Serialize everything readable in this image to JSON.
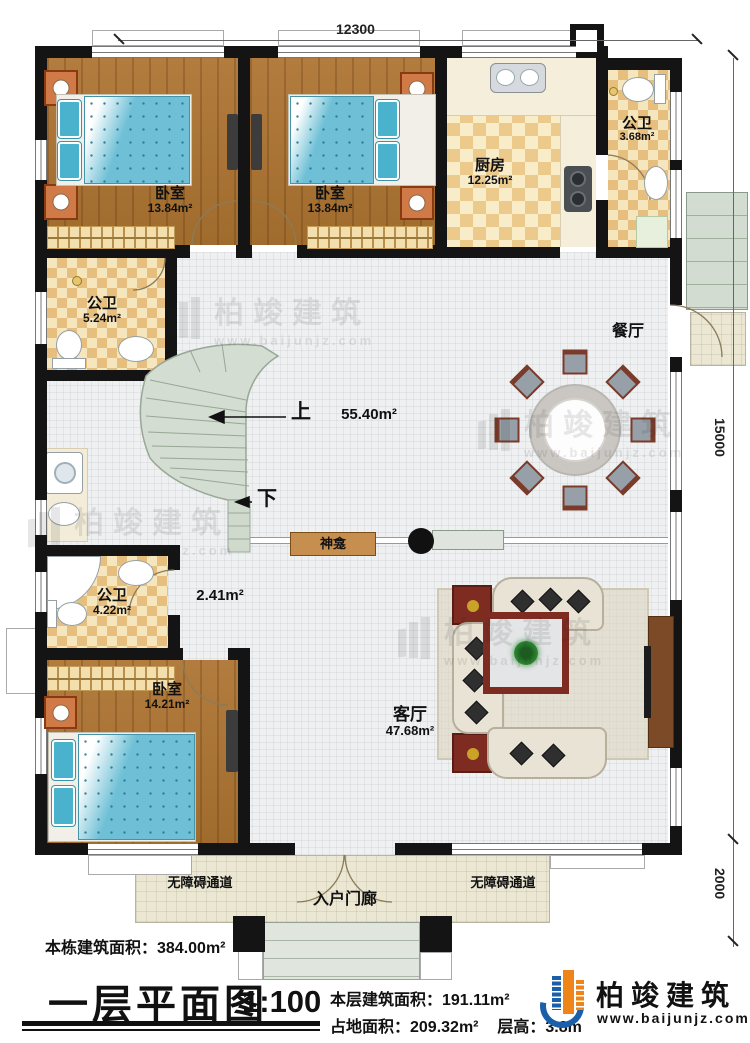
{
  "plan": {
    "dim_top": "12300",
    "dim_right": "15000",
    "dim_porch": "2000",
    "hall_area": "55.40m²",
    "corridor_area": "2.41m²",
    "rooms": {
      "bedroom1": {
        "label": "卧室",
        "area": "13.84m²"
      },
      "bedroom2": {
        "label": "卧室",
        "area": "13.84m²"
      },
      "bedroom3": {
        "label": "卧室",
        "area": "14.21m²"
      },
      "kitchen": {
        "label": "厨房",
        "area": "12.25m²"
      },
      "bath_top": {
        "label": "公卫",
        "area": "3.68m²"
      },
      "bath_mid": {
        "label": "公卫",
        "area": "5.24m²"
      },
      "bath_low": {
        "label": "公卫",
        "area": "4.22m²"
      },
      "dining": {
        "label": "餐厅"
      },
      "living": {
        "label": "客厅",
        "area": "47.68m²"
      }
    },
    "annotations": {
      "up": "上",
      "down": "下",
      "shrine": "神龛",
      "porch": "入户门廊",
      "ramp_left": "无障碍通道",
      "ramp_right": "无障碍通道"
    }
  },
  "watermark": {
    "cn": "柏竣建筑",
    "url": "www.baijunjz.com"
  },
  "title_block": {
    "total_area": "本栋建筑面积：384.00m²",
    "title": "一层平面图",
    "scale": "1:100",
    "floor_area": "本层建筑面积：191.11m²",
    "footprint": "占地面积：209.32m²",
    "floor_height": "层高：3.8m"
  },
  "logo": {
    "cn": "柏竣建筑",
    "url": "www.baijunjz.com"
  },
  "colors": {
    "wall": "#141414",
    "wood": "#ad7536",
    "tile_hall": "#eef0f2",
    "checker": "#e6be7e",
    "stairs": "#d3ddd1",
    "logo_blue": "#1a5fa8",
    "logo_orange": "#ef8418"
  }
}
